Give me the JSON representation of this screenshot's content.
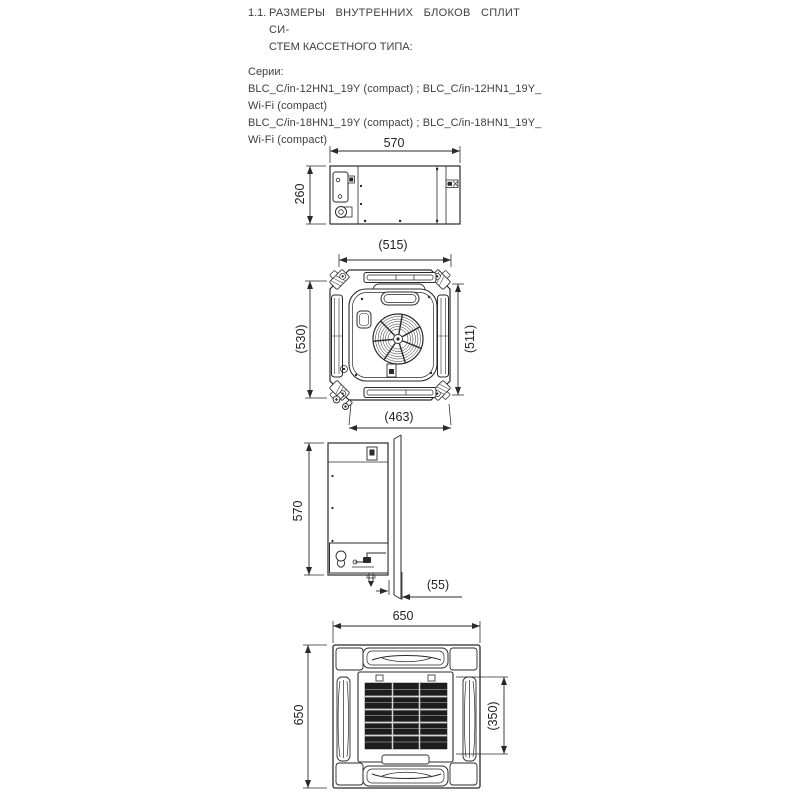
{
  "header": {
    "number": "1.1.",
    "title_line1": "РАЗМЕРЫ ВНУТРЕННИХ БЛОКОВ СПЛИТ СИ-",
    "title_line2": "СТЕМ КАССЕТНОГО ТИПА:"
  },
  "series": {
    "label": "Серии:",
    "lines": [
      "BLC_C/in-12HN1_19Y (compact) ; BLC_C/in-12HN1_19Y_",
      "Wi-Fi (compact)",
      "BLC_C/in-18HN1_19Y (compact) ; BLC_C/in-18HN1_19Y_",
      "Wi-Fi (compact)"
    ]
  },
  "dimensions": {
    "body_width": "570",
    "body_height": "260",
    "cassette_top": "(515)",
    "cassette_left": "(530)",
    "cassette_right": "(511)",
    "cassette_bottom": "(463)",
    "side_height": "570",
    "side_flange_depth": "(55)",
    "panel_width": "650",
    "panel_height": "650",
    "panel_grille_height": "(350)"
  }
}
